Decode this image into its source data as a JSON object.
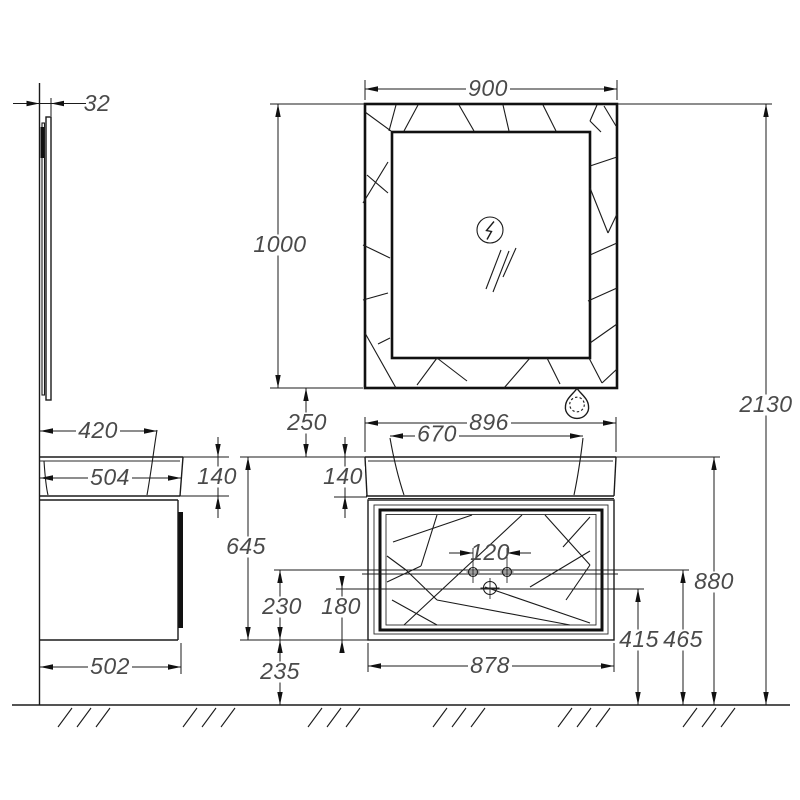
{
  "drawing": {
    "title": "bathroom-vanity-dimension-drawing",
    "dimensions": {
      "mirror_depth": "32",
      "mirror_width": "900",
      "mirror_height": "1000",
      "total_height": "2130",
      "mirror_gap": "250",
      "basin_depth": "420",
      "counter_depth": "504",
      "counter_thickness": "140",
      "counter_width": "896",
      "basin_width": "670",
      "vanity_height": "645",
      "faucet_spacing": "120",
      "outlet_upper_offset": "230",
      "outlet_lower_offset": "180",
      "cabinet_width": "878",
      "outlet_lower_height": "415",
      "outlet_upper_height": "465",
      "counter_height": "880",
      "cabinet_depth": "502",
      "bottom_clearance": "235"
    },
    "icons": {
      "power": "lightning-in-circle",
      "ornament": "teardrop-with-dotted-circle",
      "glare": "mirror-glare-slashes",
      "floor": "hatched-ground-line"
    },
    "colors": {
      "line": "#1b1b1b",
      "text": "#4a4a4a",
      "background": "#ffffff"
    }
  }
}
